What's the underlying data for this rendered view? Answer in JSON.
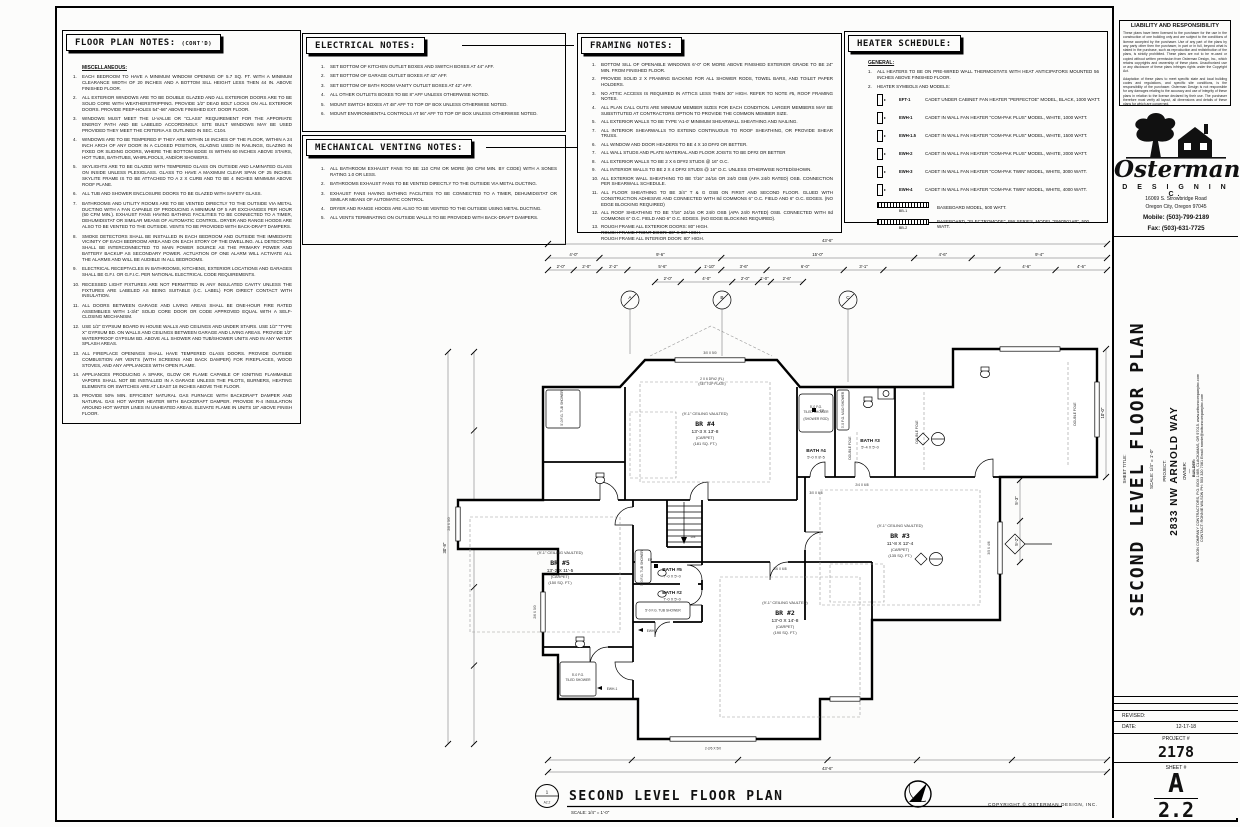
{
  "sheet": {
    "copyright": "COPYRIGHT © OSTERMAN DESIGN, INC."
  },
  "floor_plan_notes": {
    "title": "FLOOR PLAN NOTES:",
    "title_suffix": "(CONT'D)",
    "subtitle": "MISCELLANEOUS:",
    "items": [
      {
        "n": "1.",
        "t": "EACH BEDROOM TO HAVE A MINIMUM WINDOW OPENING OF 5.7 SQ. FT. WITH A MINIMUM CLEARANCE WIDTH OF 20 INCHES AND A BOTTOM SILL HEIGHT LESS THEN 44 IN. ABOVE FINISHED FLOOR."
      },
      {
        "n": "2.",
        "t": "ALL EXTERIOR WINDOWS ARE TO BE DOUBLE GLAZED AND ALL EXTERIOR DOORS ARE TO BE SOLID CORE WITH WEATHERSTRIPPING.  PROVIDE 1/2\" DEAD BOLT LOCKS ON ALL EXTERIOR DOORS.  PROVIDE PEEP-HOLES 54\"-66\" ABOVE FINISHED EXT. DOOR FLOOR."
      },
      {
        "n": "3.",
        "t": "WINDOWS MUST MEET THE U-VALUE OR \"CLASS\" REQUIREMENT FOR THE APPORIATE ENERGY PATH AND BE LABELED ACCORDINGLY.  SITE BUILT WINDOWS MAY BE USED PROVIDED THEY MEET THE CRITERIA AS OUTLINED IN SEC. C104."
      },
      {
        "n": "4.",
        "t": "WINDOWS ARE TO BE TEMPERED IF THEY ARE WITHIN 18 INCHES OF THE FLOOR, WITHIN A 24 INCH ARCH OF ANY DOOR IN A CLOSED POSITION, GLAZING USED IN RAILINGS, GLAZING IN FIXED OR SLIDING DOORS, WHERE THE BOTTOM EDGE IS WITHIN 60 INCHES ABOVE STAIRS, HOT TUBS, BATHTUBS, WHIRLPOOLS, AND/OR SHOWERS."
      },
      {
        "n": "5.",
        "t": "SKYLIGHTS ARE TO BE GLAZED WITH TEMPERED GLASS ON OUTSIDE AND LAMINATED GLASS ON INSIDE UNLESS PLEXIGLASS.  GLASS TO HAVE A MAXIMUM CLEAR SPAN OF 25 INCHES.  SKYLITE FRAME IS TO BE ATTACHED TO A 2 X CURB AND TO BE 4 INCHES MINIMUM ABOVE ROOF PLANE."
      },
      {
        "n": "6.",
        "t": "ALL TUB AND SHOWER ENCLOSURE DOORS TO BE GLAZED WITH SAFETY GLASS."
      },
      {
        "n": "7.",
        "t": "BATHROOMS AND UTILITY ROOMS ARE TO BE VENTED DIRECTLY TO THE OUTSIDE VIA METAL DUCTING WITH A FAN CAPABLE OF PRODUCING A MINIMUM OF 5 AIR EXCHANGES PER HOUR (50 CFM MIN.).  EXHAUST FANS HAVING BATHING FACILITIES TO BE CONNECTED TO A TIMER, DEHUMIDISTAT OR SIMILAR MEANS OF AUTOMATIC CONTROL.  DRYER AND RANGE HOODS ARE ALSO TO BE VENTED TO THE OUTSIDE.  VENTS TO BE PROVIDED WITH BACK-DRAFT DAMPERS."
      },
      {
        "n": "8.",
        "t": "SMOKE DETECTORS SHALL BE INSTALLED IN EACH BEDROOM AND OUTSIDE THE IMMEDIATE VICINITY OF EACH BEDROOM AREA AND ON EACH STORY OF THE DWELLING.  ALL DETECTORS SHALL BE INTERCONNECTED TO MAIN POWER SOURCE AS THE PRIMARY POWER AND BATTERY BACKUP AS SECONDARY POWER.  ACTUATION OF ONE ALARM WILL ACTIVATE ALL THE ALARMS AND WILL BE AUDIBLE IN ALL BEDROOMS."
      },
      {
        "n": "9.",
        "t": "ELECTRICAL RECEPTACLES IN BATHROOMS, KITCHENS, EXTERIOR LOCATIONS AND GARAGES SHALL BE G.F.I. OR G.F.I.C. PER NATIONAL ELECTRICAL CODE REQUIREMENTS."
      },
      {
        "n": "10.",
        "t": "RECESSED LIGHT FIXTURES ARE NOT PERMITTED IN ANY INSULATED CAVITY UNLESS THE FIXTURES ARE LABELED AS BEING SUITABLE (I.C. LABEL) FOR DIRECT CONTACT WITH INSULATION."
      },
      {
        "n": "11.",
        "t": "ALL DOORS BETWEEN GARAGE AND LIVING AREAS SHALL BE ONE-HOUR FIRE RATED ASSEMBLIES WITH 1-3/4\" SOLID CORE DOOR OR CODE APPROVED EQUAL WITH A SELF-CLOSING MECHANISM."
      },
      {
        "n": "12.",
        "t": "USE 1/2\" GYPSUM BOARD IN HOUSE WALLS AND CEILINGS AND UNDER STAIRS.  USE 1/2\" \"TYPE X\" GYPSUM BD. ON WALLS AND CEILINGS BETWEEN GARAGE AND LIVING AREAS.  PROVIDE 1/2\" WATERPROOF GYPSUM BD. ABOVE ALL SHOWER AND TUB/SHOWER UNITS AND IN ANY WATER SPLASH AREAS."
      },
      {
        "n": "13.",
        "t": "ALL FIREPLACE OPENINGS SHALL HAVE TEMPERED GLASS DOORS.  PROVIDE OUTSIDE COMBUSTION AIR VENTS (WITH SCREENS AND BACK DAMPER) FOR FIREPLACES, WOOD STOVES, AND ANY APPLIANCES WITH OPEN FLAME."
      },
      {
        "n": "14.",
        "t": "APPLIANCES PRODUCING A SPARK, GLOW OR FLAME CAPABLE OF IGNITING FLAMMABLE VAPORS SHALL NOT BE INSTALLED IN A GARAGE UNLESS THE PILOTS, BURNERS, HEATING ELEMENTS OR SWITCHES ARE AT LEAST 18 INCHES ABOVE THE FLOOR."
      },
      {
        "n": "15.",
        "t": "PROVIDE 50% MIN. EFFICIENT NATURAL GAS FURNACE WITH BACKDRAFT DAMPER AND NATURAL GAS HOT WATER HEATER WITH BACKDRAFT DAMPER.  PROVIDE R-4 INSULATION AROUND HOT WATER LINES IN UNHEATED AREAS.  ELEVATE FLAME IN UNITS 18\" ABOVE FINISH FLOOR."
      }
    ]
  },
  "electrical_notes": {
    "title": "ELECTRICAL NOTES:",
    "items": [
      {
        "n": "1.",
        "t": "SET BOTTOM OF KITCHEN OUTLET BOXES AND SWITCH BOXES AT 44\" AFF."
      },
      {
        "n": "2.",
        "t": "SET BOTTOM OF GARAGE OUTLET BOXES AT 42\" AFF."
      },
      {
        "n": "3.",
        "t": "SET BOTTOM OF BATH ROOM VANITY OUTLET BOXES AT 42\" AFF."
      },
      {
        "n": "4.",
        "t": "ALL OTHER OUTLETS BOXES TO BE 8\" AFF UNLESS OTHERWISE NOTED."
      },
      {
        "n": "5.",
        "t": "MOUNT SWITCH BOXES AT 48\" AFF TO TOP OF BOX UNLESS OTHERWISE NOTED."
      },
      {
        "n": "6.",
        "t": "MOUNT ENVIRONMENTAL CONTROLS AT 56\" AFF TO TOP OF BOX UNLESS OTHERWISE NOTED."
      }
    ]
  },
  "mechanical_venting_notes": {
    "title": "MECHANICAL VENTING NOTES:",
    "items": [
      {
        "n": "1.",
        "t": "ALL BATHROOM EXHAUST FANS TO BE 110 CFM OR MORE (80 CFM MIN. BY CODE) WITH A SONES RATING 1.0 OR LESS."
      },
      {
        "n": "2.",
        "t": "BATHROOMS EXHAUST FANS TO BE VENTED DIRECTLY TO THE OUTSIDE VIA METAL DUCTING."
      },
      {
        "n": "3.",
        "t": "EXHAUST FANS HAVING BATHING FACILITIES TO BE CONNECTED TO A TIMER, DEHUMIDISTAT OR SIMILAR MEANS OF AUTOMATIC CONTROL."
      },
      {
        "n": "4.",
        "t": "DRYER AND RANGE HOODS ARE ALSO TO BE VENTED TO THE OUTSIDE USING METAL DUCTING."
      },
      {
        "n": "5.",
        "t": "ALL VENTS TERMINATING ON OUTSIDE WALLS TO BE PROVIDED WITH BACK-DRAFT DAMPERS."
      }
    ]
  },
  "framing_notes": {
    "title": "FRAMING NOTES:",
    "items": [
      {
        "n": "1.",
        "t": "BOTTOM SILL OF OPENABLE WINDOWS 6'-0\" OR MORE ABOVE FINISHED EXTERIOR GRADE TO BE 24\" MIN. FROM FINISHED FLOOR."
      },
      {
        "n": "2.",
        "t": "PROVIDE SOLID 2 X FRAMING BACKING FOR ALL SHOWER RODS, TOWEL BARS, AND TOILET PAPER HOLDERS."
      },
      {
        "n": "3.",
        "t": "NO ATTIC ACCESS IS REQUIRED IN ATTICS LESS THEN 30\" HIGH.  REFER TO NOTE #5, ROOF FRAMING NOTES."
      },
      {
        "n": "4.",
        "t": "ALL PLAN CALL OUTS ARE MINIMUM MEMBER SIZES FOR EACH CONDITION.  LARGER MEMBERS MAY BE SUBSTITUTED AT CONTRACTORS OPTION TO PROVIDE THE COMMON MEMBER SIZE."
      },
      {
        "n": "5.",
        "t": "ALL EXTERIOR WALLS TO BE TYPE 'A1-0' MINIMUM SHEARWALL SHEATHING AND NAILING."
      },
      {
        "n": "7.",
        "t": "ALL INTERIOR SHEARWALLS TO EXTEND CONTINUOUS TO ROOF SHEATHING, OR PROVIDE SHEAR TRUSS."
      },
      {
        "n": "6.",
        "t": "ALL WINDOW AND DOOR HEADERS TO BE 4 X 10 DF#2 OR BETTER."
      },
      {
        "n": "7.",
        "t": "ALL WALL STUDS AND PLATE MATERIAL AND FLOOR JOISTS TO BE DF#2 OR BETTER"
      },
      {
        "n": "8.",
        "t": "ALL EXTERIOR WALLS TO BE 2 X 6 DF#2 STUDS @ 16\" O.C."
      },
      {
        "n": "9.",
        "t": "ALL INTERIOR WALLS TO BE 2 X 4 DF#2 STUDS @ 16\" O.C. UNLESS OTHERWISE NOTED/SHOWN."
      },
      {
        "n": "10.",
        "t": "ALL EXTERIOR WALL SHEATHING TO BE 7/16\" 24/16 OR 24/0 OSB (APA 24/0 RATED) OSB.  CONNECTION PER SHEARWALL SCHEDULE."
      },
      {
        "n": "11.",
        "t": "ALL FLOOR SHEATHING TO BE 3/4\" T & G OSB ON FIRST AND SECOND FLOOR.  GLUED WITH CONSTRUCTION ADHESIVE AND CONNECTED WITH 8d COMMONS 6\" O.C. FIELD AND 6\" O.C. EDGES.  (NO EDGE BLOCKING REQUIRED)"
      },
      {
        "n": "12.",
        "t": "ALL ROOF SHEATHING TO BE 7/16\" 24/16 OR 24/0 OSB (APA 24/0 RATED) OSB.  CONNECTED WITH 8d COMMONS 6\" O.C. FIELD AND 6\" O.C. EDGES.  (NO EDGE BLOCKING REQUIRED)."
      },
      {
        "n": "13.",
        "t": "ROUGH FRAME ALL EXTERIOR DOORS:   80\" HIGH.\nROUGH FRAME FRONT DOOR:   36\" X 80\" HIGH.\nROUGH FRAME ALL INTERIOR DOOR:   80\" HIGH."
      }
    ]
  },
  "heater_schedule": {
    "title": "HEATER SCHEDULE:",
    "general_heading": "GENERAL:",
    "general_items": [
      {
        "n": "1.",
        "t": "ALL HEATERS TO BE ON PRE-WIRED WALL THERMOSTATS WITH HEAT ANTICIPATORS MOUNTED 56 INCHES ABOVE FINISHED FLOOR."
      },
      {
        "n": "2.",
        "t": "HEATER SYMBOLS AND MODELS:"
      }
    ],
    "wall_rows": [
      {
        "code": "EFT-1",
        "desc": "CADET UNDER CABINET FAN HEATER \"PERFECTOE\" MODEL, BLACK, 1000 WATT."
      },
      {
        "code": "EWH-1",
        "desc": "CADET IN WALL FAN HEATER \"COM-PAK PLUS\" MODEL, WHITE, 1000 WATT."
      },
      {
        "code": "EWH-1.5",
        "desc": "CADET IN WALL FAN HEATER \"COM-PAK PLUS\" MODEL, WHITE, 1500 WATT."
      },
      {
        "code": "EWH-2",
        "desc": "CADET IN WALL FAN HEATER \"COM-PAK PLUS\" MODEL, WHITE, 2000 WATT."
      },
      {
        "code": "EWH-3",
        "desc": "CADET IN WALL FAN HEATER \"COM-PAK TWIN\" MODEL, WHITE, 3000 WATT."
      },
      {
        "code": "EWH-4",
        "desc": "CADET IN WALL FAN HEATER \"COM-PAK TWIN\" MODEL, WHITE, 4000 WATT."
      }
    ],
    "baseboard_rows": [
      {
        "code": "BB-1",
        "desc": "BASEBOARD MODEL, 500 WATT."
      },
      {
        "code": "BB-2",
        "desc": "BASEBOARD, \"ELECTROMODE\", BW SERIES, MODEL \"BW0501AB\", 500 WATT."
      }
    ]
  },
  "title_block": {
    "liability_title": "LIABILITY AND RESPONSIBILITY",
    "liability_p1": "These plans have been licensed to the purchaser for the use in the construction of one building only and are subject to the conditions of license accepted by the purchaser.  Use of any part of the plans by any party other then the purchaser, in part or in full, beyond what is stated in the purchase, such as reproduction and redistribution of the plans, is strictly prohibited.  These plans are not to be re-used or copied without written permission from Osterman Design, Inc., which retains copyrights and ownership of these plans.  Unauthorized use or any disclosure of these plans infringes rights under the Copyright Act.",
    "liability_p2": "Adaptation of these plans to meet specific state and local building codes and regulations, and specific site conditions, is the responsibility of the purchaser.  Osterman Design is not responsible for any damages relating to the accuracy and use of integrity of these plans in relation to the license declared by their use.  The purchaser therefore must verify all layout, all dimensions and details of these plans for which are concerned.",
    "logo_name": "Osterman",
    "logo_sub": "D E S I G N  I N C.",
    "address1": "16069 S. Strowbridge Road",
    "address2": "Oregon City, Oregon 97045",
    "mobile": "Mobile: (503)-799-2189",
    "fax": "Fax: (503)-631-7725",
    "sheet_title_label": "SHEET TITLE:",
    "sheet_title": "SECOND LEVEL FLOOR PLAN",
    "sheet_scale": "SCALE:  1/4\" = 1'-0\"",
    "project_label": "PROJECT:",
    "project_name": "2833 NW ARNOLD WAY",
    "owner_label": "OWNER:",
    "owner_value": "—",
    "builder_label": "BUILDER:",
    "builder_line1": "WILSON COMPANY CONTRACTORS,  P.O. BOX 1469, CLACKAMAS, OR 97015.  www.wilsoncompanyinc.com",
    "builder_line2": "CONTACT: RONNIE WILSON  PH: 503 320 7081  Email: ronnie@wilsoncompanyinc.com",
    "revised_label": "REVISED:",
    "date_label": "DATE:",
    "date_value": "12-17-18",
    "project_no_label": "PROJECT #",
    "project_no": "2178",
    "sheet_no_label": "SHEET #",
    "sheet_letter": "A",
    "sheet_number": "2.2"
  },
  "plan": {
    "ref_num": "1",
    "ref_sheet": "A2.2",
    "title": "SECOND LEVEL FLOOR PLAN",
    "scale_note": "SCALE:  1/4\" = 1'-0\"",
    "rooms": {
      "br4": {
        "vault": "(9'-1\" CEILING VAULTED)",
        "name": "BR #4",
        "size": "13'-3 X 13'-8",
        "finish": "(CARPET)",
        "area": "(181 SQ. FT.)"
      },
      "br3": {
        "vault": "(9'-1\" CEILING VAULTED)",
        "name": "BR #3",
        "size": "11'-8 X 12'-4",
        "finish": "(CARPET)",
        "area": "(135 SQ. FT.)"
      },
      "br5": {
        "vault": "(9'-1\" CEILING VAULTED)",
        "name": "BR #5",
        "size": "13'-2 X 11'-5",
        "finish": "(CARPET)",
        "area": "(150 SQ. FT.)"
      },
      "br2": {
        "vault": "(9'-1\" CEILING VAULTED)",
        "name": "BR #2",
        "size": "13'-0 X 14'-8",
        "finish": "(CARPET)",
        "area": "(190 SQ. FT.)"
      },
      "bath4": {
        "name": "BATH #4",
        "size": "5'-0 X 8'-5"
      },
      "bath3": {
        "name": "BATH #3",
        "size": "5'-4 X 5'-0"
      },
      "bath5": {
        "name": "BATH #5",
        "size": "7'-0 X 5'-0"
      },
      "bath2": {
        "name": "BATH #2",
        "size": "7'-0 X 5'-0"
      }
    },
    "fixtures": {
      "fg1": "5'-0 F.G.",
      "fg2": "TILED SHOWER",
      "rod": "(SHOWER ROD)",
      "tub": "5'-0 F.G. TUB SHOWER",
      "mud": "3'-0 F.G. MUD SHOWER",
      "dn": "DN",
      "pole": "DOUBLE POLE",
      "ewh": "EWH-1",
      "ep": "EP"
    },
    "callouts": {
      "a": "A",
      "b": "B",
      "c": "C",
      "hdr1": "2 X 6 DF#2 (FL)",
      "hdr2": "(SET TOP PLATE)"
    },
    "window_labels": {
      "w1": "3/0 X 5/0",
      "w2": "2/8 X 5/0",
      "w3": "2/6 X 5/0",
      "w4": "2-2/6 X 5/0",
      "w5": "3/0 X 4/6",
      "d1": "2/4 X 6/8",
      "d2": "3/0 X 6/8",
      "d3": "2/6 X 6/8"
    },
    "dims": {
      "top1": [
        "43'-6\""
      ],
      "top2": [
        "4'-0\"",
        "9'-6\"",
        "15'-0\"",
        "4'-6\"",
        "9'-4\""
      ],
      "top3": [
        "2'-0\"",
        "2'-0\"",
        "2'-2\"",
        "5'-6\"",
        "1'-10\"",
        "3'-6\"",
        "6'-0\"",
        "3'-1\"",
        "",
        "4'-6\"",
        "4'-6\""
      ],
      "top4": [
        "2'-0\"",
        "4'-0\"",
        "2'-0\"",
        "1'-0\"",
        "2'-6\""
      ],
      "bottom1": [
        "43'-6\""
      ],
      "bottom2": [
        "",
        "",
        "",
        "",
        "",
        ""
      ],
      "left1": [
        "30'-8\""
      ],
      "left2": [
        "",
        "",
        "",
        "",
        ""
      ],
      "right1": [
        "5'-3\"",
        "5'-2\""
      ],
      "right2": [
        "10'-0\""
      ]
    }
  }
}
